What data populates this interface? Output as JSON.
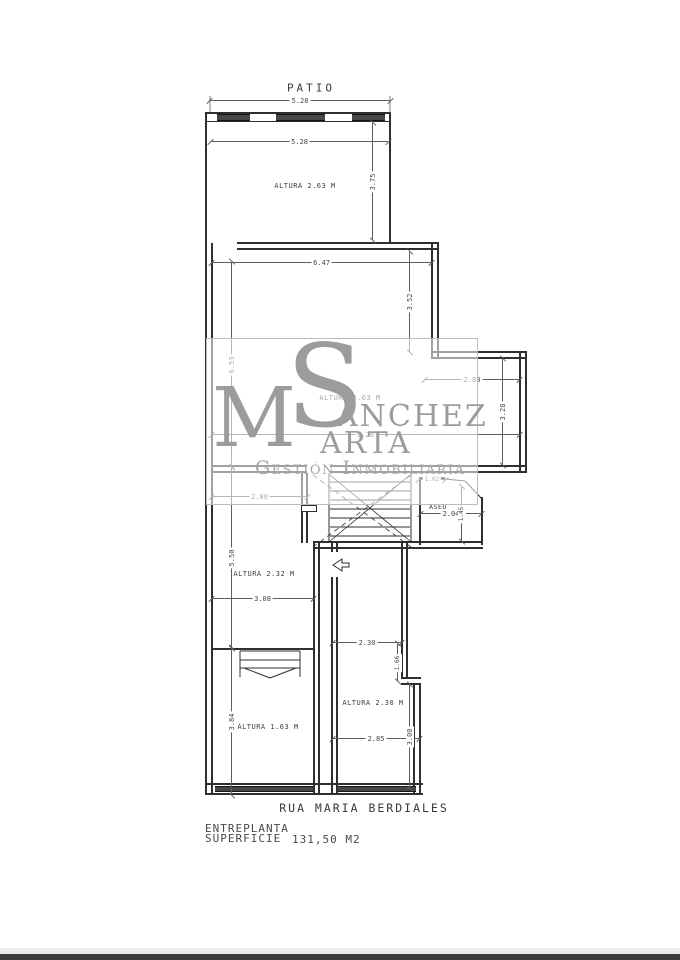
{
  "plan": {
    "patio_label": "PATIO",
    "street_label": "RUA MARIA BERDIALES",
    "footer": {
      "project_line1": "ENTREPLANTA",
      "project_line2": "SUPERFICIE",
      "area_value": "131,50 M2"
    },
    "rooms": {
      "top": "ALTURA 2.63 M",
      "middle": "ALTURA 2.63 M",
      "aseo": "ASEO",
      "left_mid": "ALTURA 2.32 M",
      "left_bottom": "ALTURA 1.63 M",
      "right_bottom": "ALTURA 2.30 M"
    },
    "dims": {
      "top_outer": "5.28",
      "top_inner": "5.28",
      "top_right_v": "3.75",
      "mid_width": "6.47",
      "mid_right_v": "3.52",
      "left_v_upper": "6.53",
      "left_v_mid": "5.50",
      "left_v_lower": "3.84",
      "bump_width": "2.88",
      "bump_v": "3.28",
      "overall_width": "9.28",
      "room_left_width": "2.80",
      "aseo_door": "1.02",
      "aseo_width": "2.04",
      "aseo_v": "1.45",
      "left_room_width": "3.08",
      "right_room_width": "2.30",
      "right_step_v": "1.66",
      "right_room_width2": "2.85",
      "right_v": "3.00"
    },
    "colors": {
      "wall": "#2f2f2f",
      "dimension": "#5d5d5d",
      "watermark": "#9c9c9c",
      "footer_bar": "#3c3c3c"
    }
  },
  "watermark": {
    "monogram_m": "M",
    "monogram_s": "S",
    "name_line1_rest": "ÁNCHEZ",
    "name_line2_rest": "ARTA",
    "tagline": "Gestión Inmobiliaria"
  }
}
